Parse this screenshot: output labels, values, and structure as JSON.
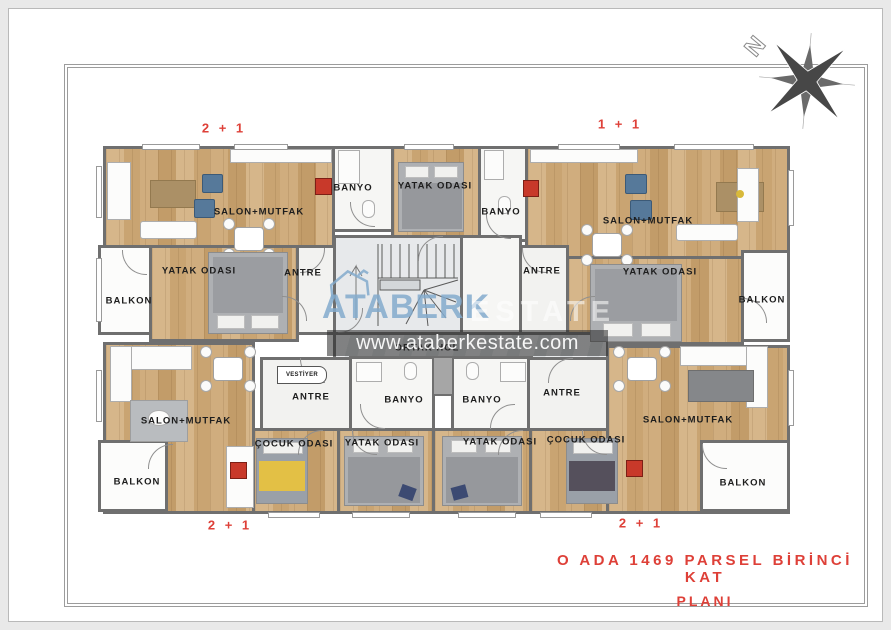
{
  "title": {
    "line1": "O ADA 1469 PARSEL BİRİNCİ KAT",
    "line2": "PLANI"
  },
  "units": {
    "top_left": "2 + 1",
    "top_right": "1 + 1",
    "bottom_left": "2 + 1",
    "bottom_right": "2 + 1"
  },
  "compass": {
    "north": "N"
  },
  "watermark": {
    "brand": "ATABERK",
    "brand_secondary": "ESTATE",
    "website": "www.ataberkestate.com"
  },
  "rooms": {
    "tl_salon": "SALON+MUTFAK",
    "tr_salon": "SALON+MUTFAK",
    "bl_salon": "SALON+MUTFAK",
    "br_salon": "SALON+MUTFAK",
    "tl_banyo": "BANYO",
    "tr_banyo": "BANYO",
    "bl_banyo": "BANYO",
    "br_banyo": "BANYO",
    "tc_yatak": "YATAK ODASI",
    "tl_yatak": "YATAK ODASI",
    "tr_yatak": "YATAK ODASI",
    "bl_yatak": "YATAK ODASI",
    "br_yatak": "YATAK ODASI",
    "bl_cocuk": "ÇOCUK ODASI",
    "br_cocuk": "ÇOCUK ODASI",
    "tl_antre": "ANTRE",
    "tr_antre": "ANTRE",
    "bl_antre": "ANTRE",
    "br_antre": "ANTRE",
    "tl_balkon": "BALKON",
    "tr_balkon": "BALKON",
    "bl_balkon": "BALKON",
    "br_balkon": "BALKON",
    "ortak_hol": "ORTAK HOL",
    "vestiyer": "VESTİYER"
  },
  "colors": {
    "accent_red": "#de4038",
    "watermark_blue": "#8fb4d2",
    "wall_gray": "#6f6f6f",
    "wood_floor": "#cdab7c",
    "hall_floor": "#dadde0"
  }
}
